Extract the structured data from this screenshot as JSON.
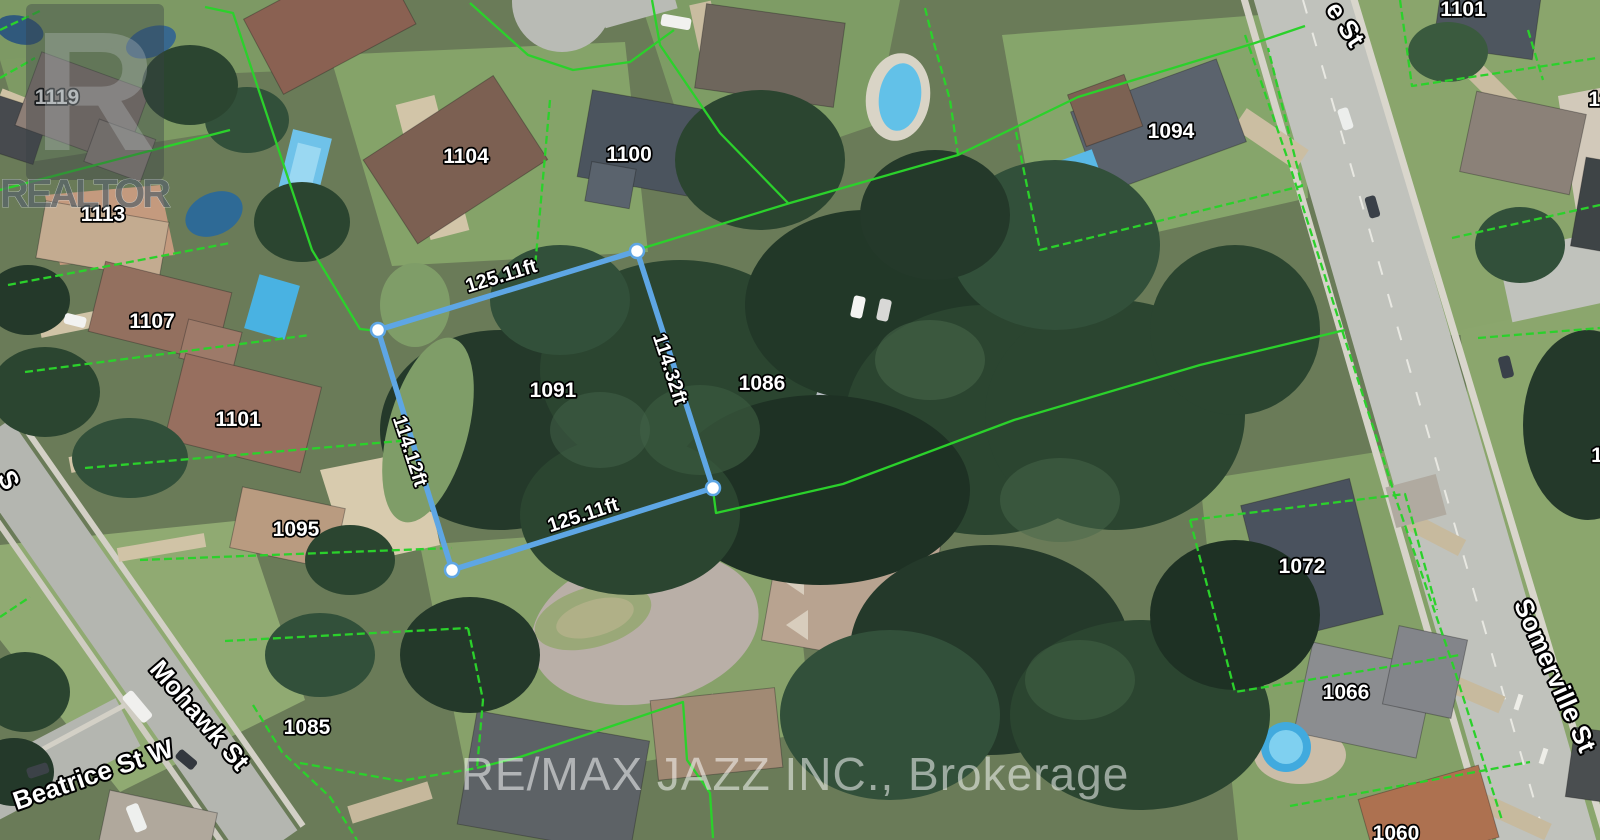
{
  "map": {
    "subject_lot": {
      "number": "1091",
      "side_top": "125.11ft",
      "side_right": "114.32ft",
      "side_left": "114.12ft",
      "side_bottom": "125.11ft"
    },
    "colors": {
      "property_line_green": "#2bd12b",
      "subject_lot_blue": "#5ea6e4",
      "label_white": "#ffffff"
    },
    "house_numbers": [
      {
        "text": "1119",
        "x": 57,
        "y": 104
      },
      {
        "text": "1113",
        "x": 103,
        "y": 221
      },
      {
        "text": "1107",
        "x": 152,
        "y": 328
      },
      {
        "text": "1101",
        "x": 238,
        "y": 426
      },
      {
        "text": "1095",
        "x": 296,
        "y": 536
      },
      {
        "text": "1085",
        "x": 307,
        "y": 734
      },
      {
        "text": "1104",
        "x": 466,
        "y": 163
      },
      {
        "text": "1100",
        "x": 629,
        "y": 161
      },
      {
        "text": "1091",
        "x": 553,
        "y": 397
      },
      {
        "text": "1086",
        "x": 762,
        "y": 390
      },
      {
        "text": "1094",
        "x": 1171,
        "y": 138
      },
      {
        "text": "1072",
        "x": 1302,
        "y": 573
      },
      {
        "text": "1066",
        "x": 1346,
        "y": 699
      },
      {
        "text": "1060",
        "x": 1396,
        "y": 840
      },
      {
        "text": "1101",
        "x": 1463,
        "y": 16
      },
      {
        "text": "12",
        "x": 1600,
        "y": 106
      },
      {
        "text": "1",
        "x": 1597,
        "y": 462
      }
    ],
    "street_labels": [
      {
        "text": "Mohawk St",
        "x": 193,
        "y": 721,
        "r": 49
      },
      {
        "text": "Beatrice St W",
        "x": 96,
        "y": 783,
        "r": -19
      },
      {
        "text": "Somerville St",
        "x": 1547,
        "y": 679,
        "r": 66
      },
      {
        "text": "e St",
        "x": 1338,
        "y": 29,
        "r": 57
      },
      {
        "text": "S",
        "x": 1,
        "y": 484,
        "r": 62
      }
    ],
    "dimension_labels": [
      {
        "text": "125.11ft",
        "x": 503,
        "y": 282,
        "r": -17
      },
      {
        "text": "114.32ft",
        "x": 664,
        "y": 371,
        "r": 72
      },
      {
        "text": "114.12ft",
        "x": 404,
        "y": 453,
        "r": 72
      },
      {
        "text": "125.11ft",
        "x": 585,
        "y": 521,
        "r": -18
      }
    ],
    "watermarks": {
      "realtor": "REALTOR",
      "realtor_r": "R",
      "brokerage": "RE/MAX JAZZ INC., Brokerage"
    }
  }
}
